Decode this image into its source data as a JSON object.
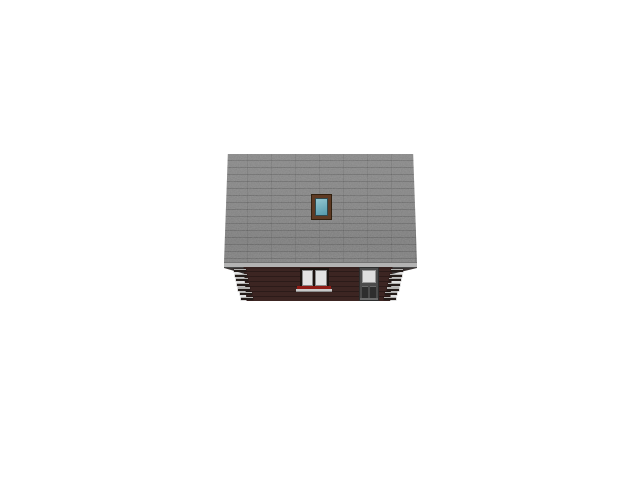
{
  "scene": {
    "description": "3D architectural side elevation render of a log house with large shingled roof, roof window, double window and entrance door",
    "background_color": "#ffffff",
    "roof": {
      "name": "shingle-roof",
      "color": "#7e7e7e",
      "row_line_color": "#646464",
      "seam_color": "#6f6f6f",
      "fascia_color": "#b3b3b3"
    },
    "skylight": {
      "name": "roof-window",
      "frame_color": "#5e3a23",
      "glass_top_color": "#93c6cf",
      "glass_bottom_color": "#569aac"
    },
    "wall": {
      "name": "log-wall",
      "color": "#3c2522",
      "line_color": "#2c1a17"
    },
    "log_ends": {
      "count_per_corner": 7,
      "face_color": "#b2b1af",
      "shadow_color": "#241c19"
    },
    "window": {
      "pane_count": 2,
      "pane_color": "#e3e3e3",
      "frame_color": "#8a8a8a",
      "sill_color": "#8e1b15",
      "sill_base_color": "#c9c9c9"
    },
    "door": {
      "frame_color": "#4b4b4b",
      "glass_color": "#dedede",
      "panel_count": 2,
      "panel_color": "#2e2e2e"
    }
  },
  "css_vars": {
    "--bg": "#ffffff",
    "--roof": "#7e7e7e",
    "--fascia": "#b3b3b3",
    "--sky-frame": "#5e3a23",
    "--sky-glass-top": "#93c6cf",
    "--sky-glass-bot": "#569aac",
    "--wall": "#3c2522",
    "--log-face": "#b2b1af",
    "--log-shadow": "#241c19",
    "--pane": "#e3e3e3",
    "--sill": "#8e1b15",
    "--sill-base": "#c9c9c9",
    "--door": "#4b4b4b",
    "--door-glass": "#dedede",
    "--door-panel": "#2e2e2e"
  }
}
